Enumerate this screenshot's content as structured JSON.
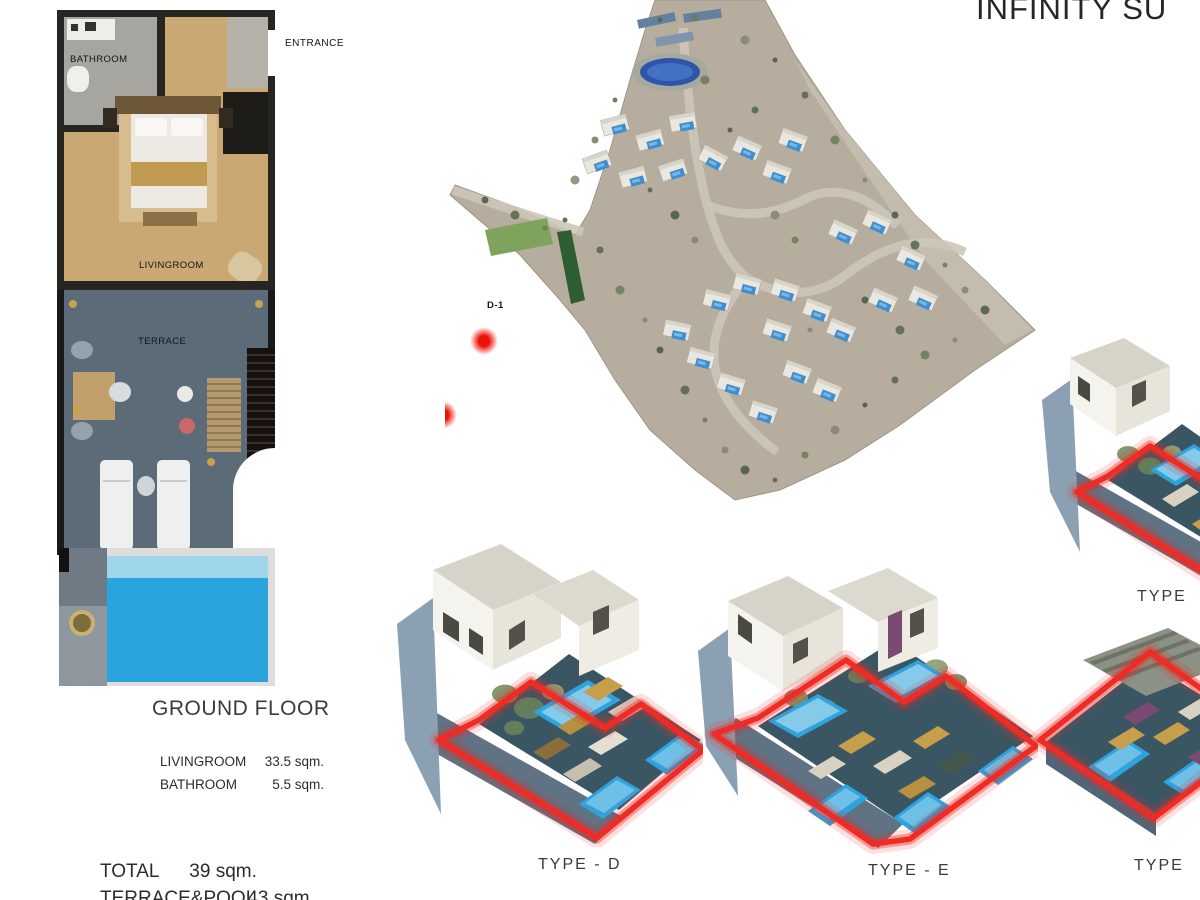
{
  "title": "INFINITY SU",
  "floorplan": {
    "room_labels": {
      "bathroom": "BATHROOM",
      "entrance": "ENTRANCE",
      "livingroom": "LIVINGROOM",
      "terrace": "TERRACE"
    },
    "caption": "GROUND FLOOR",
    "areas": [
      {
        "label": "LIVINGROOM",
        "value": "33.5 sqm."
      },
      {
        "label": "BATHROOM",
        "value": "5.5 sqm."
      }
    ],
    "totals": [
      {
        "label": "TOTAL",
        "value": "39 sqm."
      },
      {
        "label": "TERRACE&POOL",
        "value": "43 sqm."
      }
    ]
  },
  "siteplan": {
    "markers": [
      {
        "x": 352,
        "y": 186,
        "label": "",
        "lx": 0,
        "ly": 0
      },
      {
        "x": 484,
        "y": 341,
        "label": "D-1",
        "lx": 487,
        "ly": 308
      },
      {
        "x": 361,
        "y": 390,
        "label": "E-1",
        "lx": 381,
        "ly": 356
      },
      {
        "x": 443,
        "y": 415,
        "label": "E-2",
        "lx": 428,
        "ly": 384
      },
      {
        "x": 260,
        "y": 392,
        "label": "F-1",
        "lx": 268,
        "ly": 377
      },
      {
        "x": 315,
        "y": 418,
        "label": "F-2",
        "lx": 314,
        "ly": 405
      },
      {
        "x": 348,
        "y": 455,
        "label": "F-3",
        "lx": 352,
        "ly": 445
      }
    ],
    "villas": [
      {
        "x": 170,
        "y": 125,
        "r": -15
      },
      {
        "x": 205,
        "y": 140,
        "r": -15
      },
      {
        "x": 238,
        "y": 122,
        "r": -10
      },
      {
        "x": 152,
        "y": 162,
        "r": -20
      },
      {
        "x": 188,
        "y": 177,
        "r": -15
      },
      {
        "x": 228,
        "y": 170,
        "r": -18
      },
      {
        "x": 268,
        "y": 158,
        "r": 28
      },
      {
        "x": 302,
        "y": 148,
        "r": 24
      },
      {
        "x": 332,
        "y": 172,
        "r": 20
      },
      {
        "x": 348,
        "y": 140,
        "r": 20
      },
      {
        "x": 398,
        "y": 232,
        "r": 24
      },
      {
        "x": 432,
        "y": 222,
        "r": 24
      },
      {
        "x": 466,
        "y": 258,
        "r": 24
      },
      {
        "x": 478,
        "y": 298,
        "r": 24
      },
      {
        "x": 438,
        "y": 300,
        "r": 24
      },
      {
        "x": 272,
        "y": 300,
        "r": 14
      },
      {
        "x": 302,
        "y": 284,
        "r": 15
      },
      {
        "x": 340,
        "y": 290,
        "r": 18
      },
      {
        "x": 372,
        "y": 310,
        "r": 20
      },
      {
        "x": 332,
        "y": 330,
        "r": 18
      },
      {
        "x": 396,
        "y": 330,
        "r": 22
      },
      {
        "x": 256,
        "y": 358,
        "r": 15
      },
      {
        "x": 286,
        "y": 384,
        "r": 17
      },
      {
        "x": 318,
        "y": 412,
        "r": 18
      },
      {
        "x": 232,
        "y": 330,
        "r": 12
      },
      {
        "x": 352,
        "y": 372,
        "r": 20
      },
      {
        "x": 382,
        "y": 390,
        "r": 22
      }
    ]
  },
  "renderings": {
    "type_d_label": "TYPE - D",
    "type_e_label": "TYPE - E",
    "type_right_top_label": "TYPE",
    "type_right_bottom_label": "TYPE"
  },
  "colors": {
    "accent_red": "#ee2b24",
    "pool_blue": "#2fa3dd",
    "terrace_slate": "#5b6b78",
    "floor_tan": "#c9a874",
    "land_beige": "#b6ad9e"
  }
}
